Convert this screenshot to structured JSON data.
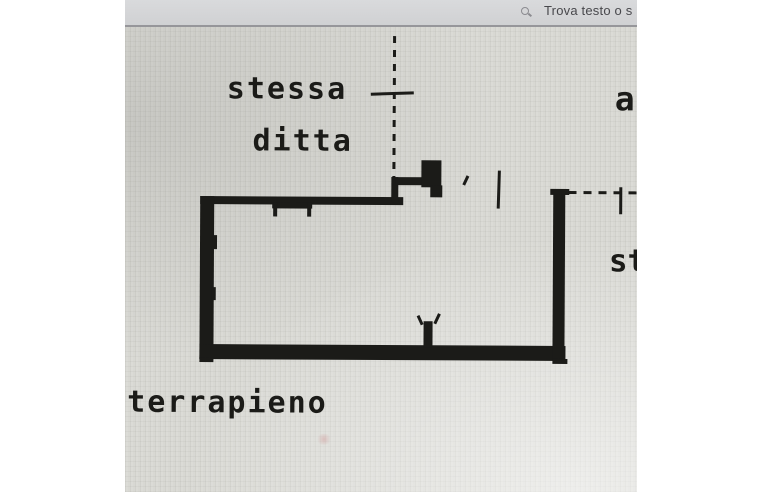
{
  "viewer_toolbar": {
    "find_label": "Trova testo o s",
    "search_icon": "magnifier",
    "colors": {
      "toolbar_bg": "#d3d4d6",
      "toolbar_text": "#48484c",
      "divider": "#96969a"
    }
  },
  "floorplan": {
    "labels": {
      "stessa": "stessa",
      "ditta": "ditta",
      "terrapieno": "terrapieno",
      "right_edge_partial_top": "a",
      "right_edge_partial_mid": "st"
    },
    "colors": {
      "ink": "#1b1b18",
      "paper": "#d8d8d3",
      "page_margin": "#ffffff"
    }
  }
}
